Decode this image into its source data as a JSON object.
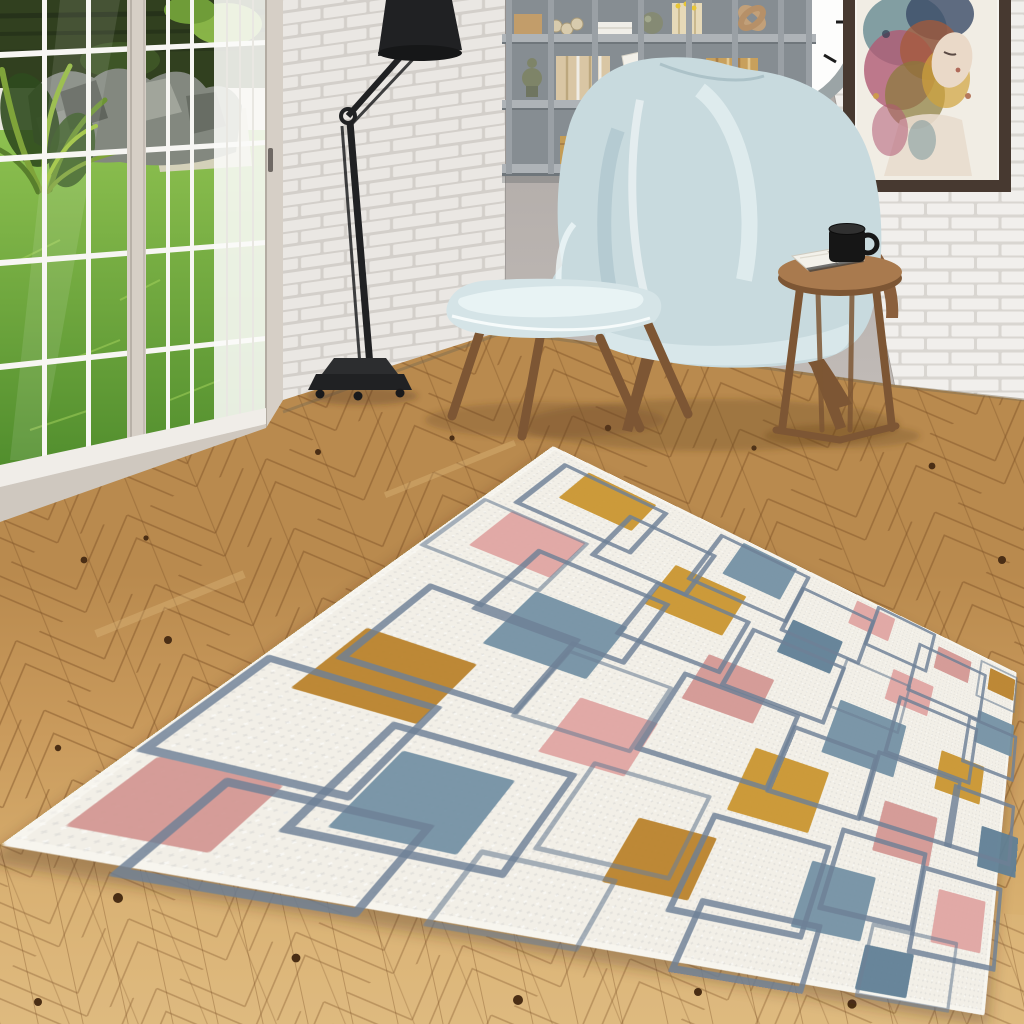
{
  "scene": {
    "type": "interior-product-photo",
    "room": "reading corner with sliding glass door to garden",
    "objects": [
      {
        "name": "sliding-glass-door",
        "desc": "white grid-pane door, garden view with grass, rocks and plants"
      },
      {
        "name": "white-brick-wall-left",
        "desc": "painted white brick wall section beside the window"
      },
      {
        "name": "plaster-wall",
        "desc": "warm gray plaster wall behind chair and shelf"
      },
      {
        "name": "white-brick-wall-right",
        "desc": "white brick wall with clock and artwork"
      },
      {
        "name": "floor-lamp",
        "desc": "black articulated architect floor lamp on wheeled base"
      },
      {
        "name": "wall-shelf",
        "desc": "gray cubby wall shelf with books, boxes, sphere and wooden knot"
      },
      {
        "name": "wingback-chair",
        "desc": "glossy pale-blue high wingback chair with wooden legs"
      },
      {
        "name": "ottoman",
        "desc": "matching pale-blue ottoman with splayed wooden legs"
      },
      {
        "name": "side-table",
        "desc": "round wooden side table with black mug and open book"
      },
      {
        "name": "wall-clock",
        "desc": "round clock, gray rim, white face, partially cropped at top"
      },
      {
        "name": "framed-artwork",
        "desc": "watercolor portrait of a woman in a dark frame"
      },
      {
        "name": "herringbone-floor",
        "desc": "light oak herringbone parquet with dark knots"
      },
      {
        "name": "area-rug",
        "desc": "cream rug with overlapping blue-gray square outlines and solid squares in mustard, dusty pink and slate blue"
      }
    ]
  },
  "palette": {
    "brick": "#f1efec",
    "mortar": "#d9d6d1",
    "plaster": "#b6b0ac",
    "frame_beige": "#d6cfc6",
    "mullion": "#f7f6f3",
    "grass_light": "#8ec150",
    "grass_dark": "#4f8c2c",
    "foliage": "#31401f",
    "leaf": "#7fa33a",
    "rock": "#83887f",
    "gravel": "#d8d2bf",
    "floor_light": "#ddb97d",
    "floor_mid": "#c99a5c",
    "floor_dark": "#b98a4e",
    "floor_line": "#7a4e24",
    "knot": "#4a2e15",
    "lamp_black": "#202123",
    "shelf_gray": "#9aa0a5",
    "shelf_dark": "#868d92",
    "shelf_light": "#aeb3b7",
    "chair_blue": "#c8dade",
    "chair_blue_light": "#e8f3f4",
    "chair_blue_dark": "#a9c2c9",
    "wood_leg": "#7d5634",
    "wood_table": "#a97a4e",
    "clock_rim": "#9ba4a6",
    "clock_face": "#fdfdfc",
    "clock_hand": "#1c1c1c",
    "frame_dark": "#473930",
    "matte": "#f6f4ef",
    "mug_black": "#161616",
    "rug_bg": "#f2efe7",
    "rug_line": "#6e8096",
    "rug_mustard": "#c9952f",
    "rug_mustard2": "#b9822a",
    "rug_pink": "#dfa5a1",
    "rug_pink2": "#d29793",
    "rug_slate": "#7390a4",
    "rug_slate2": "#5f7e95"
  },
  "rug": {
    "fills": [
      {
        "x": 60,
        "y": 18,
        "w": 100,
        "h": 74,
        "c": "m"
      },
      {
        "x": 300,
        "y": 8,
        "w": 98,
        "h": 86,
        "c": "s"
      },
      {
        "x": 520,
        "y": 14,
        "w": 82,
        "h": 62,
        "c": "p"
      },
      {
        "x": 705,
        "y": 30,
        "w": 80,
        "h": 58,
        "c": "p2"
      },
      {
        "x": 832,
        "y": 22,
        "w": 66,
        "h": 58,
        "c": "m2"
      },
      {
        "x": 36,
        "y": 150,
        "w": 92,
        "h": 80,
        "c": "p"
      },
      {
        "x": 238,
        "y": 118,
        "w": 112,
        "h": 92,
        "c": "m"
      },
      {
        "x": 432,
        "y": 122,
        "w": 92,
        "h": 76,
        "c": "s2"
      },
      {
        "x": 628,
        "y": 132,
        "w": 86,
        "h": 70,
        "c": "p"
      },
      {
        "x": 818,
        "y": 140,
        "w": 88,
        "h": 74,
        "c": "s"
      },
      {
        "x": 128,
        "y": 258,
        "w": 112,
        "h": 96,
        "c": "s"
      },
      {
        "x": 348,
        "y": 250,
        "w": 100,
        "h": 84,
        "c": "p2"
      },
      {
        "x": 556,
        "y": 238,
        "w": 124,
        "h": 102,
        "c": "s"
      },
      {
        "x": 756,
        "y": 258,
        "w": 92,
        "h": 76,
        "c": "m"
      },
      {
        "x": 38,
        "y": 382,
        "w": 102,
        "h": 86,
        "c": "m2"
      },
      {
        "x": 248,
        "y": 380,
        "w": 92,
        "h": 80,
        "c": "p"
      },
      {
        "x": 466,
        "y": 368,
        "w": 112,
        "h": 96,
        "c": "m"
      },
      {
        "x": 676,
        "y": 382,
        "w": 96,
        "h": 80,
        "c": "p2"
      },
      {
        "x": 858,
        "y": 370,
        "w": 78,
        "h": 70,
        "c": "s2"
      },
      {
        "x": 148,
        "y": 498,
        "w": 100,
        "h": 84,
        "c": "s"
      },
      {
        "x": 378,
        "y": 502,
        "w": 92,
        "h": 76,
        "c": "m2"
      },
      {
        "x": 596,
        "y": 498,
        "w": 96,
        "h": 84,
        "c": "s"
      },
      {
        "x": 796,
        "y": 490,
        "w": 86,
        "h": 74,
        "c": "p"
      },
      {
        "x": 16,
        "y": 556,
        "w": 82,
        "h": 64,
        "c": "p2"
      },
      {
        "x": 700,
        "y": 584,
        "w": 74,
        "h": 52,
        "c": "s2"
      }
    ],
    "outlines": [
      {
        "x": 28,
        "y": 22,
        "w": 140,
        "h": 100
      },
      {
        "x": 142,
        "y": 62,
        "w": 122,
        "h": 92
      },
      {
        "x": 262,
        "y": 12,
        "w": 150,
        "h": 110
      },
      {
        "x": 420,
        "y": 42,
        "w": 132,
        "h": 100
      },
      {
        "x": 560,
        "y": 2,
        "w": 120,
        "h": 92
      },
      {
        "x": 662,
        "y": 44,
        "w": 150,
        "h": 108
      },
      {
        "x": 806,
        "y": 12,
        "w": 88,
        "h": 88,
        "thin": 1
      },
      {
        "x": 2,
        "y": 148,
        "w": 120,
        "h": 100,
        "thin": 1
      },
      {
        "x": 92,
        "y": 192,
        "w": 160,
        "h": 110
      },
      {
        "x": 232,
        "y": 162,
        "w": 130,
        "h": 100
      },
      {
        "x": 382,
        "y": 172,
        "w": 150,
        "h": 108
      },
      {
        "x": 540,
        "y": 152,
        "w": 120,
        "h": 98,
        "thin": 1
      },
      {
        "x": 652,
        "y": 182,
        "w": 158,
        "h": 108
      },
      {
        "x": 798,
        "y": 162,
        "w": 104,
        "h": 90
      },
      {
        "x": 42,
        "y": 302,
        "w": 150,
        "h": 110
      },
      {
        "x": 202,
        "y": 322,
        "w": 120,
        "h": 98,
        "thin": 1
      },
      {
        "x": 332,
        "y": 292,
        "w": 160,
        "h": 118
      },
      {
        "x": 502,
        "y": 312,
        "w": 130,
        "h": 100
      },
      {
        "x": 642,
        "y": 302,
        "w": 150,
        "h": 108
      },
      {
        "x": 792,
        "y": 312,
        "w": 118,
        "h": 98
      },
      {
        "x": 2,
        "y": 442,
        "w": 130,
        "h": 100
      },
      {
        "x": 122,
        "y": 472,
        "w": 160,
        "h": 108
      },
      {
        "x": 302,
        "y": 452,
        "w": 130,
        "h": 100,
        "thin": 1
      },
      {
        "x": 452,
        "y": 472,
        "w": 150,
        "h": 108
      },
      {
        "x": 622,
        "y": 442,
        "w": 130,
        "h": 100
      },
      {
        "x": 762,
        "y": 462,
        "w": 136,
        "h": 108
      },
      {
        "x": 62,
        "y": 560,
        "w": 140,
        "h": 74
      },
      {
        "x": 262,
        "y": 572,
        "w": 120,
        "h": 64,
        "thin": 1
      },
      {
        "x": 482,
        "y": 572,
        "w": 140,
        "h": 64
      },
      {
        "x": 702,
        "y": 556,
        "w": 130,
        "h": 78,
        "thin": 1
      }
    ]
  }
}
